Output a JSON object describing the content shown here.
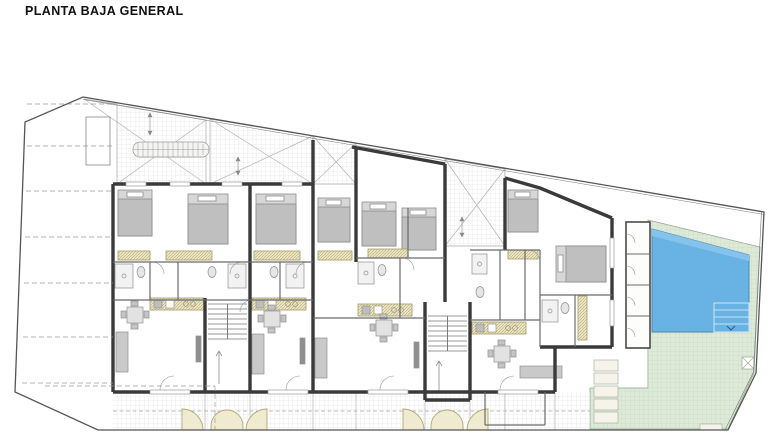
{
  "title": "PLANTA BAJA GENERAL",
  "tables": [
    {
      "title": "CUADRO RESUMEN DE SUPERFICIES",
      "columns": [
        "TIPO",
        "UNDS.",
        "SUP. ÚTIL",
        "SUP. CONST."
      ],
      "rows": [
        {
          "c": [
            "Aparcamientos",
            "8",
            "--",
            "105.91 m2"
          ],
          "total": false
        },
        {
          "c": [
            "Piscina(lamina agua)",
            "1",
            "--",
            "25.52 m2"
          ],
          "total": false
        },
        {
          "c": [
            "Recinto Piscina",
            "--",
            "--",
            "42.78 m2"
          ],
          "total": false
        },
        {
          "c": [
            "Patios",
            "4",
            "--",
            "76.22 m2"
          ],
          "total": false
        },
        {
          "c": [
            "zona Telecomunic.",
            "--",
            "--",
            "4.74 m2"
          ],
          "total": false
        },
        {
          "c": [
            "Z.Comun.N.escaleras",
            "2",
            "--",
            "9.30 m2"
          ],
          "total": false
        },
        {
          "c": [
            "Superf. Planta Baja",
            "--",
            "--",
            "277.30 m2"
          ],
          "total": false
        },
        {
          "c": [
            "Jardin delantero de viv.",
            "4",
            "--",
            "68.04 m2"
          ],
          "total": false
        },
        {
          "c": [
            "Trasteros",
            "4",
            "--",
            "12.85 m2"
          ],
          "total": false
        },
        {
          "c": [
            "TOTAL SUPERFICIES",
            "--",
            "--",
            "622.66 m2"
          ],
          "total": true
        }
      ]
    },
    {
      "title": "CUADRO SUPERFICIES VIVIENDAS",
      "columns": [
        "TIPO",
        "UNDS.",
        "SUP. ÚTIL",
        "SUP. CONST."
      ],
      "rows": [
        {
          "c": [
            "Vivienda 1",
            "1",
            "57.33 m2",
            "67.92 m2"
          ],
          "total": false
        },
        {
          "c": [
            "Vivienda 2",
            "1",
            "57.795 m2",
            "66.815 m2"
          ],
          "total": false
        },
        {
          "c": [
            "Vivienda 3",
            "1",
            "62.415 m2",
            "72.565 m2"
          ],
          "total": false
        },
        {
          "c": [
            "Vivienda 4",
            "1",
            "67.17 m2",
            "84.795 m2"
          ],
          "total": false
        },
        {
          "c": [
            "Total planta baja",
            "4",
            "244.71 m2",
            "292.095 m2"
          ],
          "total": true
        },
        {
          "c": [
            "Vivienda 5",
            "1",
            "55.295 m2",
            "70.225 m2"
          ],
          "total": false
        },
        {
          "c": [
            "Vivienda 6",
            "1",
            "55.295 m2",
            "68.615 m2"
          ],
          "total": false
        },
        {
          "c": [
            "Vivienda 7",
            "1",
            "60.345 m2",
            "73.325 m2"
          ],
          "total": false
        },
        {
          "c": [
            "Vivienda 8",
            "1",
            "58.745 m2",
            "74.555 m2"
          ],
          "total": false
        },
        {
          "c": [
            "Total planta primera",
            "4",
            "229.68 m2",
            "286.72 m2"
          ],
          "total": true
        },
        {
          "c": [
            "TOTAL SUPERFICIES",
            "8",
            "474.71 m2",
            "578.815 m2"
          ],
          "total": true
        }
      ]
    }
  ],
  "plan": {
    "room_labels": [
      {
        "l1": "jardin",
        "l2": "29.06m2",
        "x": 163,
        "y": 150,
        "fs": 3.8
      },
      {
        "l1": "patio",
        "l2": "15.66m2",
        "x": 260,
        "y": 157,
        "fs": 3.8
      },
      {
        "l1": "patio",
        "l2": "9.58m2",
        "x": 335,
        "y": 162,
        "fs": 3.4
      },
      {
        "l1": "patio",
        "l2": "10.33m2",
        "x": 474,
        "y": 208,
        "fs": 3.6
      },
      {
        "l1": "dormitorio 2",
        "l2": "11.70m2",
        "x": 137,
        "y": 244,
        "fs": 3.4
      },
      {
        "l1": "dormitorio 1",
        "l2": "14.24m2",
        "x": 207,
        "y": 252,
        "fs": 3.4
      },
      {
        "l1": "dormitorio 1",
        "l2": "14.24m2",
        "x": 276,
        "y": 252,
        "fs": 3.4
      },
      {
        "l1": "dormitorio 2",
        "l2": "11.22m2",
        "x": 334,
        "y": 250,
        "fs": 3.2
      },
      {
        "l1": "dormitorio 2",
        "l2": "10.00m2",
        "x": 379,
        "y": 196,
        "fs": 3.1
      },
      {
        "l1": "dormitorio 1",
        "l2": "14.15m2",
        "x": 388,
        "y": 252,
        "fs": 3.2
      },
      {
        "l1": "vestidor",
        "l2": "4.14m2",
        "x": 426,
        "y": 244,
        "fs": 3.1
      },
      {
        "l1": "dormitorio 1",
        "l2": "10.31m2",
        "x": 532,
        "y": 242,
        "fs": 3.3
      },
      {
        "l1": "dormitorio 2",
        "l2": "11.23m2",
        "x": 578,
        "y": 230,
        "fs": 3.3
      },
      {
        "l1": "baño 2",
        "l2": "3.96m2",
        "x": 131,
        "y": 277,
        "fs": 3.1
      },
      {
        "l1": "paso",
        "l2": "1.98m2",
        "x": 163,
        "y": 272,
        "fs": 3.1
      },
      {
        "l1": "baño 1",
        "l2": "3.30m2",
        "x": 197,
        "y": 277,
        "fs": 3.1
      },
      {
        "l1": "baño 1",
        "l2": "3.76m2",
        "x": 266,
        "y": 277,
        "fs": 3.1
      },
      {
        "l1": "baño 1",
        "l2": "3.70m2",
        "x": 489,
        "y": 282,
        "fs": 3.1
      },
      {
        "l1": "vestidor",
        "l2": "3.25m2",
        "x": 512,
        "y": 262,
        "fs": 3.1
      },
      {
        "l1": "paso",
        "l2": "2.14m2",
        "x": 531,
        "y": 280,
        "fs": 3.1
      },
      {
        "l1": "baño 2",
        "l2": "3.70m2",
        "x": 556,
        "y": 320,
        "fs": 3.1
      },
      {
        "l1": "porche",
        "l2": "5.16m2",
        "x": 592,
        "y": 322,
        "fs": 3.1
      },
      {
        "l1": "salón-comedor-cocina",
        "l2": "21.05m2",
        "x": 172,
        "y": 324,
        "fs": 3.4
      },
      {
        "l1": "salón-comedor-cocina",
        "l2": "21.05m2",
        "x": 276,
        "y": 324,
        "fs": 3.4
      },
      {
        "l1": "salón-comedor-cocina",
        "l2": "21.05m2",
        "x": 369,
        "y": 328,
        "fs": 3.4
      },
      {
        "l1": "salón-comedor-cocina",
        "l2": "24.12m2",
        "x": 505,
        "y": 332,
        "fs": 3.4
      },
      {
        "l1": "porche",
        "l2": "6.15m2",
        "x": 158,
        "y": 398,
        "fs": 3.2
      },
      {
        "l1": "jardin",
        "l2": "5.40m2",
        "x": 158,
        "y": 415,
        "fs": 3.2
      },
      {
        "l1": "porche",
        "l2": "7.03m2",
        "x": 287,
        "y": 398,
        "fs": 3.2
      },
      {
        "l1": "jardin",
        "l2": "8.04m2",
        "x": 287,
        "y": 415,
        "fs": 3.2
      },
      {
        "l1": "porche",
        "l2": "7.63m2",
        "x": 377,
        "y": 398,
        "fs": 3.2
      },
      {
        "l1": "jardin",
        "l2": "8.04m2",
        "x": 377,
        "y": 415,
        "fs": 3.2
      },
      {
        "l1": "acceso 1",
        "l2": "4.02m2",
        "x": 227,
        "y": 412,
        "fs": 3.2
      },
      {
        "l1": "acceso 2",
        "l2": "4.03m2",
        "x": 447,
        "y": 412,
        "fs": 3.2
      },
      {
        "l1": "porche",
        "l2": "7.03m2",
        "x": 510,
        "y": 398,
        "fs": 3.2
      },
      {
        "l1": "jardin",
        "l2": "10.99m2",
        "x": 556,
        "y": 412,
        "fs": 3.2
      },
      {
        "l1": "trastero",
        "l2": "3.21m2",
        "x": 638,
        "y": 282,
        "fs": 2.9
      },
      {
        "l1": "piscina",
        "l2": "25.52m2",
        "x": 700,
        "y": 280,
        "fs": 3.6
      },
      {
        "l1": "recinto piscina",
        "l2": "42.78m2",
        "x": 688,
        "y": 368,
        "fs": 3.5
      }
    ],
    "parking_numbers": [
      {
        "n": "1",
        "x": 29,
        "y": 108
      },
      {
        "n": "2",
        "x": 28,
        "y": 146
      },
      {
        "n": "3",
        "x": 27,
        "y": 191
      },
      {
        "n": "4",
        "x": 26,
        "y": 237
      },
      {
        "n": "5",
        "x": 25,
        "y": 283
      },
      {
        "n": "6",
        "x": 24,
        "y": 337
      },
      {
        "n": "7",
        "x": 23,
        "y": 383
      },
      {
        "n": "8",
        "x": 50,
        "y": 424
      }
    ],
    "cars": [
      {
        "x": 32,
        "y": 104,
        "w": 82,
        "h": 35
      },
      {
        "x": 31,
        "y": 150,
        "w": 82,
        "h": 35
      },
      {
        "x": 30,
        "y": 196,
        "w": 82,
        "h": 35
      },
      {
        "x": 29,
        "y": 242,
        "w": 82,
        "h": 35
      },
      {
        "x": 28,
        "y": 290,
        "w": 80,
        "h": 38
      },
      {
        "x": 27,
        "y": 344,
        "w": 78,
        "h": 34
      },
      {
        "x": 48,
        "y": 390,
        "w": 76,
        "h": 31
      }
    ],
    "access_numbers": [
      {
        "n": "1",
        "x": 193,
        "y": 421
      },
      {
        "n": "2",
        "x": 257,
        "y": 421
      },
      {
        "n": "3",
        "x": 414,
        "y": 421
      },
      {
        "n": "4",
        "x": 477,
        "y": 421
      }
    ],
    "trastero_numbers": [
      {
        "n": "5",
        "x": 618,
        "y": 236
      },
      {
        "n": "6",
        "x": 617,
        "y": 267
      },
      {
        "n": "7",
        "x": 617,
        "y": 299
      },
      {
        "n": "8",
        "x": 617,
        "y": 330
      }
    ],
    "garden": {
      "loungers": [
        {
          "x": 652,
          "y": 398,
          "r": -38
        },
        {
          "x": 671,
          "y": 406,
          "r": -18
        },
        {
          "x": 700,
          "y": 398,
          "r": 14
        },
        {
          "x": 719,
          "y": 390,
          "r": 26
        },
        {
          "x": 742,
          "y": 388,
          "r": 42
        }
      ],
      "tables": [
        {
          "x": 667,
          "y": 416
        },
        {
          "x": 722,
          "y": 404
        }
      ],
      "plants": [
        {
          "x": 744,
          "y": 380
        },
        {
          "x": 698,
          "y": 419
        },
        {
          "x": 649,
          "y": 363
        }
      ]
    },
    "colors": {
      "pool": "#69b2e4",
      "pool_edge": "#4f87ad",
      "garden": "#dcead7",
      "wall": "#3a3a3a",
      "hatch_fill": "#ede6c6",
      "hatch_line": "#b3a86e",
      "furniture": "#c9c9c9"
    }
  }
}
